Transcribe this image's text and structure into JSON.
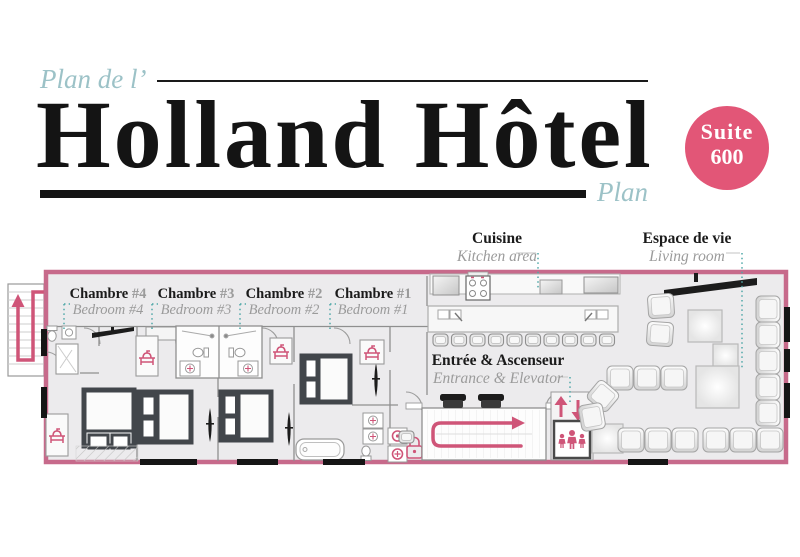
{
  "header": {
    "pretitle": "Plan de l’",
    "title": "Holland Hôtel",
    "corner_label": "Plan",
    "badge": {
      "line1": "Suite",
      "line2": "600"
    }
  },
  "areas": {
    "kitchen": {
      "fr": "Cuisine",
      "en": "Kitchen area"
    },
    "living": {
      "fr": "Espace de vie",
      "en": "Living room"
    },
    "entrance": {
      "fr": "Entrée & Ascenseur",
      "en": "Entrance & Elevator"
    },
    "bedrooms": [
      {
        "fr": "Chambre",
        "number": "#4",
        "en": "Bedroom #4"
      },
      {
        "fr": "Chambre",
        "number": "#3",
        "en": "Bedroom #3"
      },
      {
        "fr": "Chambre",
        "number": "#2",
        "en": "Bedroom #2"
      },
      {
        "fr": "Chambre",
        "number": "#1",
        "en": "Bedroom #1"
      }
    ]
  },
  "icons": {
    "stairs_arrow": "u-turn-up-arrow",
    "entrance_path": "looping-right-arrow",
    "elevator_arrows": "up-down-arrows",
    "elevator_people": "three-person-group",
    "vanity": "pink-washbasin"
  },
  "colors": {
    "accent_pink": "#cf5578",
    "border_pink": "#c76a8b",
    "badge_pink": "#e25677",
    "title_teal": "#9cc2c7",
    "leader_teal": "#4fa8a8",
    "floor_gray": "#ecebed",
    "ink": "#141414"
  }
}
